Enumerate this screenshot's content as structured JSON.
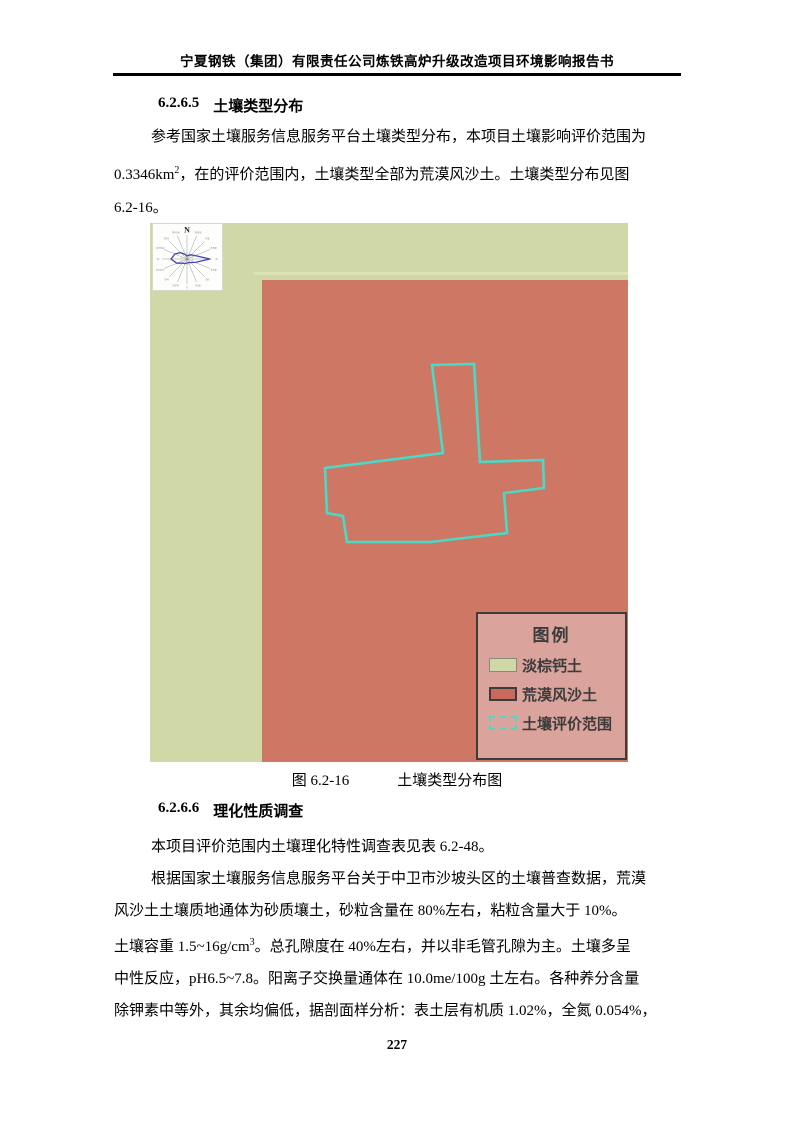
{
  "page": {
    "header_title": "宁夏钢铁（集团）有限责任公司炼铁高炉升级改造项目环境影响报告书",
    "page_number": "227"
  },
  "section_1": {
    "heading_number": "6.2.6.5",
    "heading_text": "土壤类型分布",
    "para_line1": "参考国家土壤服务信息服务平台土壤类型分布，本项目土壤影响评价范围为",
    "para_line2_pre": "0.3346km",
    "para_line2_sup": "2",
    "para_line2_post": "，在的评价范围内，土壤类型全部为荒漠风沙土。土壤类型分布见图",
    "para_line3": "6.2-16。"
  },
  "figure": {
    "caption_label": "图 6.2-16",
    "caption_title": "土壤类型分布图",
    "wind_rose": {
      "north_label": "N",
      "dirs": [
        "NNE",
        "NE",
        "ENE",
        "E",
        "ESE",
        "SE",
        "SSE",
        "S",
        "SSW",
        "SW",
        "WSW",
        "W",
        "WNW",
        "NW",
        "NNW"
      ]
    },
    "legend": {
      "title": "图例",
      "items": [
        {
          "label": "淡棕钙土",
          "swatch_color": "#d0d8a8"
        },
        {
          "label": "荒漠风沙土",
          "swatch_color": "#c8695c"
        },
        {
          "label": "土壤评价范围",
          "swatch_color": "#4ad9c6"
        }
      ]
    },
    "colors": {
      "light_brown_calcium_soil": "#d0d8a8",
      "desert_wind_sand_soil": "#cf7765",
      "evaluation_boundary": "#4ad9c6",
      "legend_background": "#daa49c"
    }
  },
  "section_2": {
    "heading_number": "6.2.6.6",
    "heading_text": "理化性质调查",
    "para1": "本项目评价范围内土壤理化特性调查表见表 6.2-48。",
    "para2_line1": "根据国家土壤服务信息服务平台关于中卫市沙坡头区的土壤普查数据，荒漠",
    "para2_line2": "风沙土土壤质地通体为砂质壤土，砂粒含量在 80%左右，粘粒含量大于 10%。",
    "para2_line3_pre": "土壤容重 1.5~16g/cm",
    "para2_line3_sup": "3",
    "para2_line3_post": "。总孔隙度在 40%左右，并以非毛管孔隙为主。土壤多呈",
    "para2_line4": "中性反应，pH6.5~7.8。阳离子交换量通体在 10.0me/100g 土左右。各种养分含量",
    "para2_line5": "除钾素中等外，其余均偏低，据剖面样分析：表土层有机质 1.02%，全氮 0.054%，"
  }
}
